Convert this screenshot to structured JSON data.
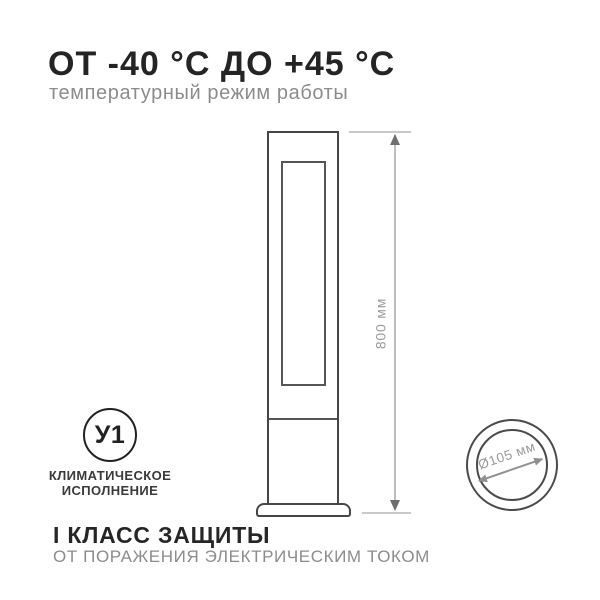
{
  "header": {
    "title": "ОТ -40 °С ДО +45 °С",
    "subtitle": "температурный режим работы"
  },
  "drawing": {
    "height_dimension": "800 мм"
  },
  "climate": {
    "badge_code": "У1",
    "label_line1": "КЛИМАТИЧЕСКОЕ",
    "label_line2": "ИСПОЛНЕНИЕ"
  },
  "top_view": {
    "diameter_dimension": "Ø105 мм"
  },
  "footer": {
    "title": "I КЛАСС ЗАЩИТЫ",
    "subtitle": "ОТ ПОРАЖЕНИЯ ЭЛЕКТРИЧЕСКИМ ТОКОМ"
  },
  "colors": {
    "ink": "#242424",
    "muted_text": "#8c8c8c",
    "drawing_stroke": "#464646",
    "dimension_line": "#bdbdbd",
    "dimension_text": "#9a9a9a"
  }
}
